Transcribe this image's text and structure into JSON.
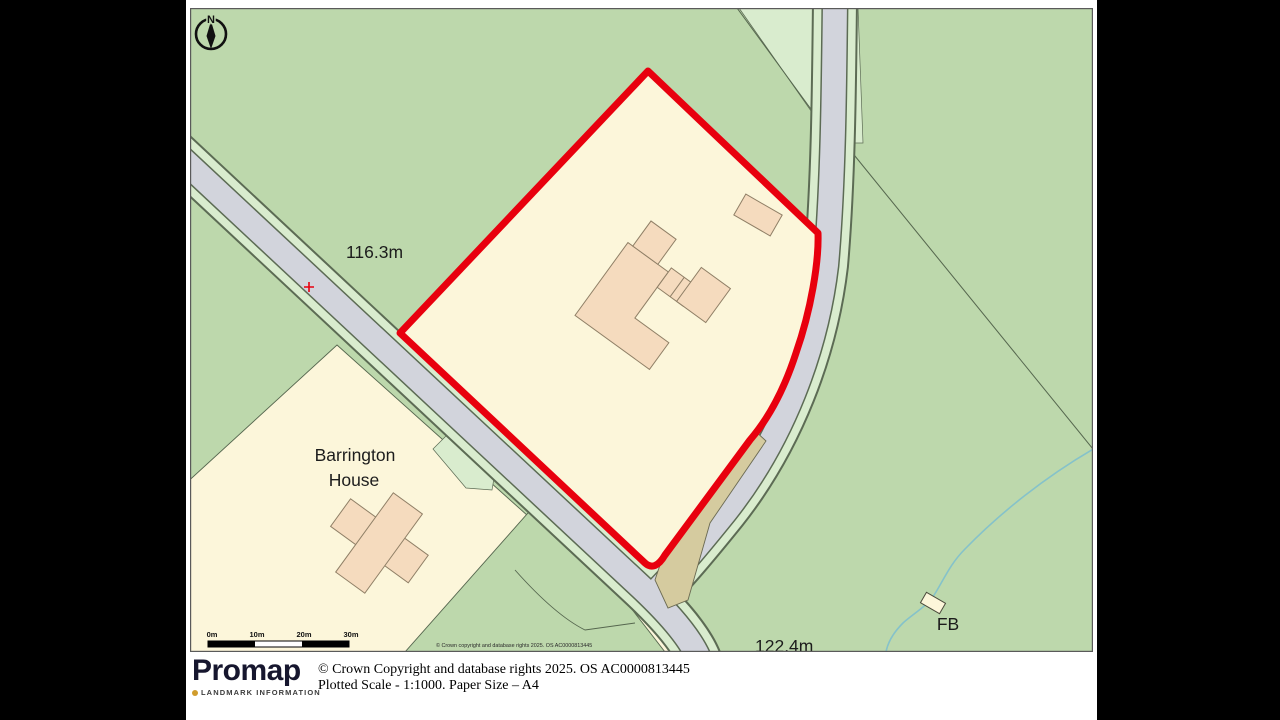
{
  "window": {
    "bg": "#000000",
    "page_bg": "#ffffff"
  },
  "map": {
    "compass_label": "N",
    "labels": {
      "spot_height_nw": "116.3m",
      "spot_height_s": "122.4m",
      "barrington_line1": "Barrington",
      "barrington_line2": "House",
      "footbridge": "FB"
    },
    "scale_bar": {
      "labels": [
        "0m",
        "10m",
        "20m",
        "30m"
      ]
    },
    "copyright_inline": "© Crown copyright and database rights 2025. OS AC0000813445",
    "colors": {
      "field_green": "#bdd8ac",
      "pale_green": "#d9ecce",
      "road_grey": "#d2d4dc",
      "road_edge": "#5c6b54",
      "parcel_cream": "#fcf6da",
      "building_peach": "#f5dbbe",
      "building_outline": "#8f7f66",
      "boundary_red": "#e8000e",
      "track_tan": "#d5cb9f",
      "stream_blue": "#85c2ca",
      "text_dark": "#1c1c1c"
    }
  },
  "footer": {
    "brand": "Promap",
    "brand_tagline": "LANDMARK INFORMATION",
    "copyright_line": "© Crown Copyright and database rights 2025. OS AC0000813445",
    "scale_line": "Plotted Scale - 1:1000. Paper Size – A4"
  }
}
